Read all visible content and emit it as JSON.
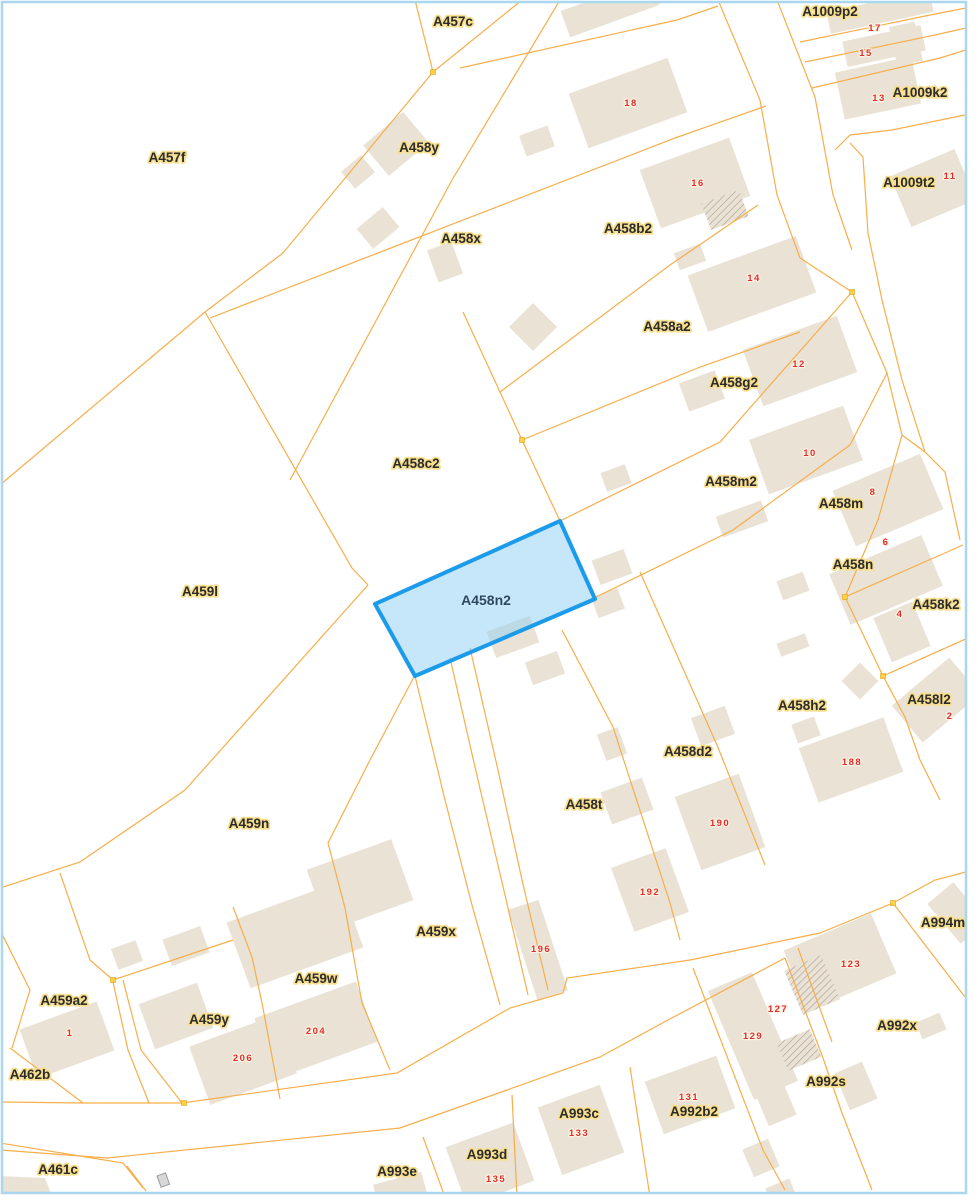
{
  "map": {
    "background": "#FFFFFF",
    "border_color": "#A9D7F0",
    "parcel_line_color": "#F6AE4B",
    "node_color": "#FFD042",
    "building_fill": "#EAE2D5",
    "building_hatch_color": "#AFA698",
    "symbol_color": "#9A9A9A",
    "label_style": {
      "color": "#2B2B2B",
      "halo": "#F8DF8F",
      "font_size": 13.5
    },
    "number_style": {
      "color": "#E22E2E",
      "halo": "#FBF3E2",
      "font_size": 9.5
    },
    "highlight": {
      "label": "A458n2",
      "points": "375,604 560,521 595,599 415,676",
      "fill": "#8ED0F4",
      "fill_opacity": 0.5,
      "stroke": "#1B9BE9",
      "stroke_width": 4,
      "label_color": "#2E4A5E",
      "label_halo": "#C8E8FB",
      "label_x": 486,
      "label_y": 605
    },
    "parcel_labels": [
      {
        "text": "A457c",
        "x": 453,
        "y": 26
      },
      {
        "text": "A1009p2",
        "x": 830,
        "y": 16
      },
      {
        "text": "A457f",
        "x": 167,
        "y": 162
      },
      {
        "text": "A458y",
        "x": 419,
        "y": 152
      },
      {
        "text": "A1009k2",
        "x": 920,
        "y": 97
      },
      {
        "text": "A1009t2",
        "x": 909,
        "y": 187
      },
      {
        "text": "A458x",
        "x": 461,
        "y": 243
      },
      {
        "text": "A458b2",
        "x": 628,
        "y": 233
      },
      {
        "text": "A458a2",
        "x": 667,
        "y": 331
      },
      {
        "text": "A458g2",
        "x": 734,
        "y": 387
      },
      {
        "text": "A458c2",
        "x": 416,
        "y": 468
      },
      {
        "text": "A458m2",
        "x": 731,
        "y": 486
      },
      {
        "text": "A458m",
        "x": 841,
        "y": 508
      },
      {
        "text": "A458n",
        "x": 853,
        "y": 569
      },
      {
        "text": "A459l",
        "x": 200,
        "y": 596
      },
      {
        "text": "A458k2",
        "x": 936,
        "y": 609
      },
      {
        "text": "A458l2",
        "x": 929,
        "y": 704
      },
      {
        "text": "A458h2",
        "x": 802,
        "y": 710
      },
      {
        "text": "A458d2",
        "x": 688,
        "y": 756
      },
      {
        "text": "A458t",
        "x": 584,
        "y": 809
      },
      {
        "text": "A459n",
        "x": 249,
        "y": 828
      },
      {
        "text": "A994m",
        "x": 943,
        "y": 927
      },
      {
        "text": "A459x",
        "x": 436,
        "y": 936
      },
      {
        "text": "A459w",
        "x": 316,
        "y": 983
      },
      {
        "text": "A459a2",
        "x": 64,
        "y": 1005
      },
      {
        "text": "A459y",
        "x": 209,
        "y": 1024
      },
      {
        "text": "A992x",
        "x": 897,
        "y": 1030
      },
      {
        "text": "A462b",
        "x": 30,
        "y": 1079
      },
      {
        "text": "A992s",
        "x": 826,
        "y": 1086
      },
      {
        "text": "A992b2",
        "x": 694,
        "y": 1116
      },
      {
        "text": "A993c",
        "x": 579,
        "y": 1118
      },
      {
        "text": "A461c",
        "x": 58,
        "y": 1174
      },
      {
        "text": "A993d",
        "x": 487,
        "y": 1159
      },
      {
        "text": "A993e",
        "x": 397,
        "y": 1176
      }
    ],
    "house_numbers": [
      {
        "text": "17",
        "x": 875,
        "y": 31
      },
      {
        "text": "15",
        "x": 866,
        "y": 56
      },
      {
        "text": "13",
        "x": 879,
        "y": 101
      },
      {
        "text": "18",
        "x": 631,
        "y": 106
      },
      {
        "text": "11",
        "x": 950,
        "y": 179
      },
      {
        "text": "16",
        "x": 698,
        "y": 186
      },
      {
        "text": "14",
        "x": 754,
        "y": 281
      },
      {
        "text": "12",
        "x": 799,
        "y": 367
      },
      {
        "text": "10",
        "x": 810,
        "y": 456
      },
      {
        "text": "8",
        "x": 873,
        "y": 495
      },
      {
        "text": "6",
        "x": 886,
        "y": 545
      },
      {
        "text": "4",
        "x": 900,
        "y": 617
      },
      {
        "text": "2",
        "x": 950,
        "y": 719
      },
      {
        "text": "188",
        "x": 852,
        "y": 765
      },
      {
        "text": "190",
        "x": 720,
        "y": 826
      },
      {
        "text": "192",
        "x": 650,
        "y": 895
      },
      {
        "text": "196",
        "x": 541,
        "y": 952
      },
      {
        "text": "123",
        "x": 851,
        "y": 967
      },
      {
        "text": "127",
        "x": 778,
        "y": 1012
      },
      {
        "text": "129",
        "x": 753,
        "y": 1039
      },
      {
        "text": "1",
        "x": 70,
        "y": 1036
      },
      {
        "text": "204",
        "x": 316,
        "y": 1034
      },
      {
        "text": "206",
        "x": 243,
        "y": 1061
      },
      {
        "text": "131",
        "x": 689,
        "y": 1100
      },
      {
        "text": "133",
        "x": 579,
        "y": 1136
      },
      {
        "text": "135",
        "x": 496,
        "y": 1182
      }
    ],
    "buildings": [
      {
        "cx": 358,
        "cy": 172,
        "w": 26,
        "h": 22,
        "a": -40
      },
      {
        "cx": 396,
        "cy": 144,
        "w": 52,
        "h": 40,
        "a": -40
      },
      {
        "cx": 378,
        "cy": 228,
        "w": 34,
        "h": 26,
        "a": -40
      },
      {
        "cx": 445,
        "cy": 262,
        "w": 26,
        "h": 34,
        "a": -20
      },
      {
        "cx": 533,
        "cy": 327,
        "w": 34,
        "h": 34,
        "a": -45
      },
      {
        "cx": 537,
        "cy": 141,
        "w": 30,
        "h": 22,
        "a": -20
      },
      {
        "cx": 610,
        "cy": 8,
        "w": 95,
        "h": 28,
        "a": -20
      },
      {
        "cx": 628,
        "cy": 103,
        "w": 105,
        "h": 58,
        "a": -20
      },
      {
        "cx": 695,
        "cy": 183,
        "w": 95,
        "h": 62,
        "a": -20
      },
      {
        "cx": 725,
        "cy": 210,
        "w": 40,
        "h": 28,
        "a": -20,
        "hatch": true
      },
      {
        "cx": 880,
        "cy": 12,
        "w": 105,
        "h": 22,
        "a": -12
      },
      {
        "cx": 884,
        "cy": 46,
        "w": 80,
        "h": 26,
        "a": -12
      },
      {
        "cx": 878,
        "cy": 88,
        "w": 78,
        "h": 48,
        "a": -12
      },
      {
        "cx": 906,
        "cy": 44,
        "w": 26,
        "h": 40,
        "a": -12
      },
      {
        "cx": 933,
        "cy": 188,
        "w": 70,
        "h": 55,
        "a": -23
      },
      {
        "cx": 752,
        "cy": 284,
        "w": 115,
        "h": 60,
        "a": -20
      },
      {
        "cx": 690,
        "cy": 257,
        "w": 28,
        "h": 18,
        "a": -20
      },
      {
        "cx": 800,
        "cy": 361,
        "w": 100,
        "h": 60,
        "a": -20
      },
      {
        "cx": 702,
        "cy": 391,
        "w": 38,
        "h": 30,
        "a": -20
      },
      {
        "cx": 806,
        "cy": 450,
        "w": 100,
        "h": 58,
        "a": -20
      },
      {
        "cx": 888,
        "cy": 500,
        "w": 95,
        "h": 60,
        "a": -23
      },
      {
        "cx": 886,
        "cy": 580,
        "w": 100,
        "h": 55,
        "a": -23
      },
      {
        "cx": 902,
        "cy": 632,
        "w": 42,
        "h": 48,
        "a": -23
      },
      {
        "cx": 936,
        "cy": 700,
        "w": 75,
        "h": 48,
        "a": -40
      },
      {
        "cx": 860,
        "cy": 681,
        "w": 26,
        "h": 26,
        "a": -45
      },
      {
        "cx": 851,
        "cy": 760,
        "w": 90,
        "h": 58,
        "a": -20
      },
      {
        "cx": 806,
        "cy": 730,
        "w": 24,
        "h": 20,
        "a": -20
      },
      {
        "cx": 720,
        "cy": 822,
        "w": 68,
        "h": 78,
        "a": -20
      },
      {
        "cx": 650,
        "cy": 890,
        "w": 58,
        "h": 68,
        "a": -20
      },
      {
        "cx": 713,
        "cy": 726,
        "w": 36,
        "h": 30,
        "a": -20
      },
      {
        "cx": 612,
        "cy": 744,
        "w": 22,
        "h": 28,
        "a": -20
      },
      {
        "cx": 627,
        "cy": 801,
        "w": 44,
        "h": 34,
        "a": -20
      },
      {
        "cx": 612,
        "cy": 567,
        "w": 34,
        "h": 26,
        "a": -20
      },
      {
        "cx": 608,
        "cy": 603,
        "w": 28,
        "h": 22,
        "a": -20
      },
      {
        "cx": 616,
        "cy": 478,
        "w": 26,
        "h": 20,
        "a": -20
      },
      {
        "cx": 742,
        "cy": 519,
        "w": 48,
        "h": 22,
        "a": -20
      },
      {
        "cx": 793,
        "cy": 586,
        "w": 28,
        "h": 20,
        "a": -20
      },
      {
        "cx": 793,
        "cy": 645,
        "w": 30,
        "h": 14,
        "a": -20
      },
      {
        "cx": 513,
        "cy": 637,
        "w": 46,
        "h": 28,
        "a": -20
      },
      {
        "cx": 545,
        "cy": 668,
        "w": 34,
        "h": 24,
        "a": -20
      },
      {
        "cx": 295,
        "cy": 935,
        "w": 120,
        "h": 70,
        "a": -20
      },
      {
        "cx": 360,
        "cy": 885,
        "w": 90,
        "h": 65,
        "a": -20
      },
      {
        "cx": 176,
        "cy": 1016,
        "w": 62,
        "h": 48,
        "a": -20
      },
      {
        "cx": 243,
        "cy": 1060,
        "w": 92,
        "h": 62,
        "a": -20
      },
      {
        "cx": 316,
        "cy": 1030,
        "w": 108,
        "h": 64,
        "a": -20
      },
      {
        "cx": 67,
        "cy": 1040,
        "w": 82,
        "h": 52,
        "a": -20
      },
      {
        "cx": 127,
        "cy": 955,
        "w": 26,
        "h": 22,
        "a": -20
      },
      {
        "cx": 186,
        "cy": 946,
        "w": 40,
        "h": 28,
        "a": -20
      },
      {
        "cx": 400,
        "cy": 1189,
        "w": 50,
        "h": 22,
        "a": -15
      },
      {
        "cx": 490,
        "cy": 1164,
        "w": 72,
        "h": 62,
        "a": -20
      },
      {
        "cx": 581,
        "cy": 1130,
        "w": 66,
        "h": 72,
        "a": -20
      },
      {
        "cx": 690,
        "cy": 1095,
        "w": 76,
        "h": 56,
        "a": -20
      },
      {
        "cx": 753,
        "cy": 1036,
        "w": 48,
        "h": 118,
        "a": -23
      },
      {
        "cx": 799,
        "cy": 1050,
        "w": 36,
        "h": 30,
        "a": -23,
        "hatch": true
      },
      {
        "cx": 772,
        "cy": 1095,
        "w": 30,
        "h": 55,
        "a": -23
      },
      {
        "cx": 840,
        "cy": 962,
        "w": 95,
        "h": 65,
        "a": -23
      },
      {
        "cx": 812,
        "cy": 985,
        "w": 40,
        "h": 48,
        "a": -23,
        "hatch": true
      },
      {
        "cx": 931,
        "cy": 1026,
        "w": 26,
        "h": 18,
        "a": -23
      },
      {
        "cx": 856,
        "cy": 1086,
        "w": 30,
        "h": 40,
        "a": -23
      },
      {
        "cx": 761,
        "cy": 1158,
        "w": 28,
        "h": 30,
        "a": -23
      },
      {
        "cx": 780,
        "cy": 1190,
        "w": 26,
        "h": 14,
        "a": -23
      },
      {
        "cx": 957,
        "cy": 913,
        "w": 34,
        "h": 52,
        "a": -40
      },
      {
        "cx": 538,
        "cy": 950,
        "w": 32,
        "h": 95,
        "a": -18
      },
      {
        "points": "0,1176 45,1178 52,1196 0,1196"
      }
    ],
    "lines": [
      {
        "points": "415,0 433,72"
      },
      {
        "points": "433,72 522,0"
      },
      {
        "points": "433,72 283,253 205,312 0,485"
      },
      {
        "points": "205,312 352,568 368,585"
      },
      {
        "points": "368,585 185,790 80,862 0,888"
      },
      {
        "points": "560,0 452,180 290,480"
      },
      {
        "points": "460,68 677,20 718,6"
      },
      {
        "points": "210,318 675,138 766,106"
      },
      {
        "points": "463,312 500,392 522,440 560,521"
      },
      {
        "points": "500,392 670,265 758,205"
      },
      {
        "points": "522,440 700,367 800,332"
      },
      {
        "points": "560,521 720,442 852,292"
      },
      {
        "points": "594,598 733,530 850,445 887,373"
      },
      {
        "points": "718,0 760,100 777,195 800,258"
      },
      {
        "points": "777,0 815,97 833,195 852,250"
      },
      {
        "points": "800,258 852,292"
      },
      {
        "points": "852,292 887,373 902,435 925,452 945,472 960,540"
      },
      {
        "points": "902,435 878,520 845,597"
      },
      {
        "points": "845,597 963,545"
      },
      {
        "points": "845,597 883,676"
      },
      {
        "points": "883,676 970,637"
      },
      {
        "points": "883,676 905,717 920,760 940,800"
      },
      {
        "points": "835,150 850,135 892,130 965,115"
      },
      {
        "points": "850,143 863,157 868,233 882,300 902,380 925,452"
      },
      {
        "points": "800,42 930,15 966,8"
      },
      {
        "points": "805,62 935,35 966,28"
      },
      {
        "points": "812,88 940,58 966,50"
      },
      {
        "points": "415,676 445,800 472,905 500,1005"
      },
      {
        "points": "450,658 478,780 505,895 528,995"
      },
      {
        "points": "470,648 498,770 522,880 548,990"
      },
      {
        "points": "562,630 613,727 670,903 680,940"
      },
      {
        "points": "640,572 717,745 765,865"
      },
      {
        "points": "0,1102 82,1103 182,1103 397,1073 510,1008 563,993 567,978 690,960 820,933 893,903 935,880 966,872"
      },
      {
        "points": "0,1150 107,1158 400,1128 600,1057 668,1020 785,958"
      },
      {
        "points": "0,1143 123,1163 143,1188"
      },
      {
        "points": "785,958 823,1058 842,1113 872,1190"
      },
      {
        "points": "893,903 965,997"
      },
      {
        "points": "693,968 763,1150 785,1190"
      },
      {
        "points": "798,948 832,1042"
      },
      {
        "points": "512,1095 517,1197"
      },
      {
        "points": "630,1067 650,1197"
      },
      {
        "points": "423,1137 445,1197"
      },
      {
        "points": "113,982 128,1050 149,1103"
      },
      {
        "points": "123,980 141,1050 182,1103"
      },
      {
        "points": "10,1048 83,1103"
      },
      {
        "points": "0,930 30,990 12,1048"
      },
      {
        "points": "60,873 90,960 113,980"
      },
      {
        "points": "113,980 203,950 233,940"
      },
      {
        "points": "233,907 252,957 262,1003 280,1099"
      },
      {
        "points": "328,843 345,908 362,1003 390,1070"
      },
      {
        "points": "415,675 370,760 328,843"
      },
      {
        "points": "127,1166 146,1191"
      }
    ],
    "nodes": [
      {
        "x": 433,
        "y": 72
      },
      {
        "x": 522,
        "y": 440
      },
      {
        "x": 852,
        "y": 292
      },
      {
        "x": 845,
        "y": 597
      },
      {
        "x": 883,
        "y": 676
      },
      {
        "x": 184,
        "y": 1103
      },
      {
        "x": 113,
        "y": 980
      },
      {
        "x": 893,
        "y": 903
      }
    ],
    "symbols": [
      {
        "x": 157,
        "y": 1176,
        "w": 9,
        "h": 12
      }
    ]
  }
}
